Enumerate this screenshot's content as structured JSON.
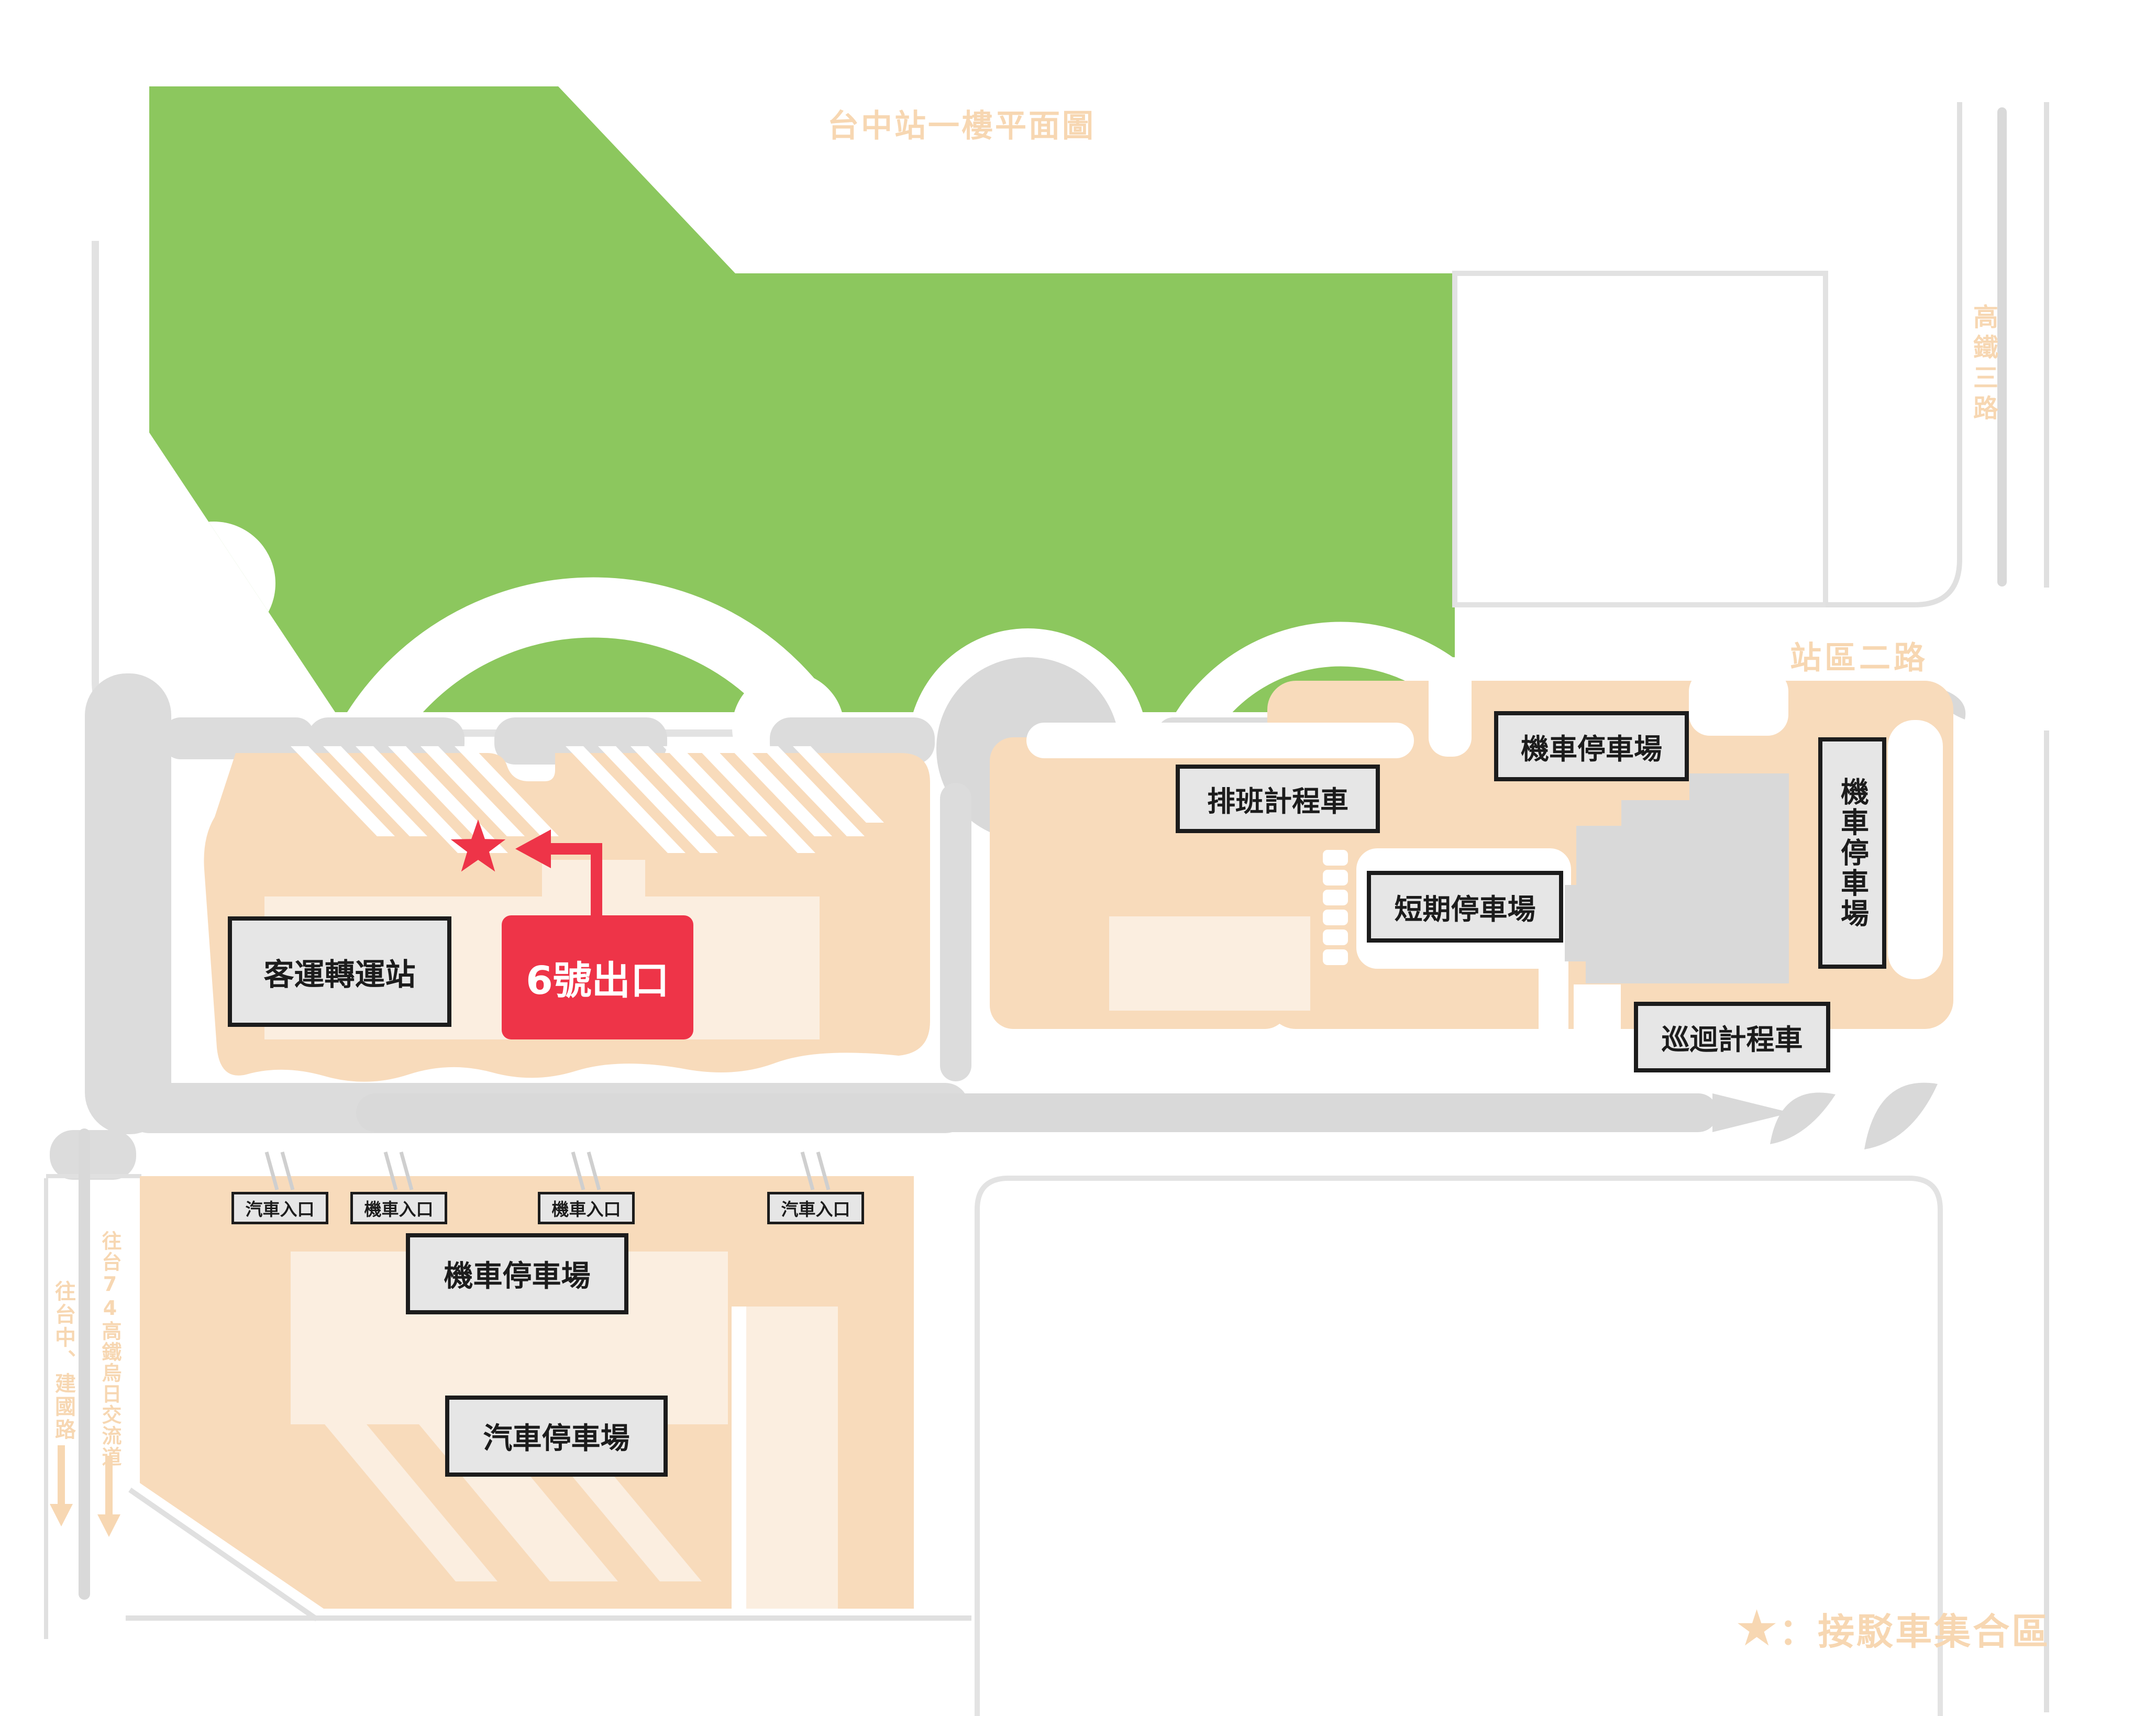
{
  "title": "台中站一樓平面圖",
  "roads": {
    "east_vertical": "高鐵三路",
    "station_area": "站區二路",
    "south_local": "往台中、建國路",
    "south_highway": "往台74高鐵烏日交流道"
  },
  "bus_terminal": {
    "label": "客運轉運站",
    "exit_label": "6號出口",
    "star_symbol": "★"
  },
  "parking_east": {
    "taxi_queue": "排班計程車",
    "moto_north": "機車停車場",
    "short_term": "短期停車場",
    "taxi_roving": "巡迴計程車",
    "moto_east": "機車停車場"
  },
  "parking_south": {
    "entrances": [
      "汽車入口",
      "機車入口",
      "機車入口",
      "汽車入口"
    ],
    "moto": "機車停車場",
    "car": "汽車停車場"
  },
  "legend": {
    "star": "★",
    "text": "：接駁車集合區"
  },
  "colors": {
    "green_building": "#8CC75E",
    "peach_block": "#F8DBBB",
    "peach_inner": "#FBEEE0",
    "road_gray": "#DCDCDC",
    "accent_red": "#EE3448",
    "label_text": "#F7D7B2"
  }
}
